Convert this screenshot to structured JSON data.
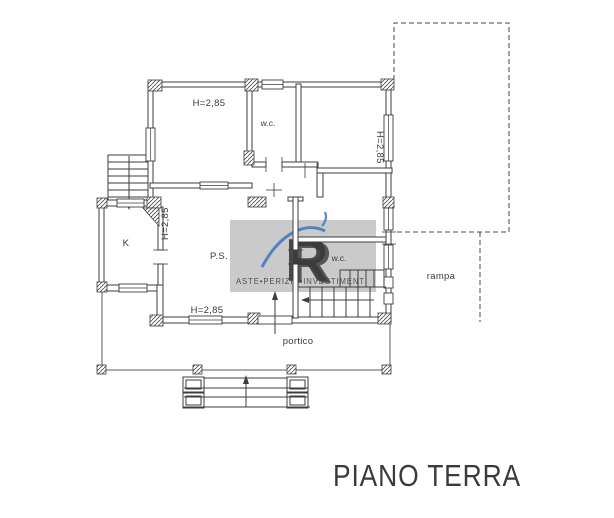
{
  "title": {
    "text": "PIANO TERRA"
  },
  "plan": {
    "labels": {
      "room_top_left_height": "H=2,85",
      "wc_top": "w.c.",
      "room_top_right_height": "H=2,85",
      "hall_left_height": "H=2,85",
      "kitchen": "K",
      "living": "P.S.",
      "wc_inner": "w.c.",
      "ramp": "rampa",
      "portico": "portico",
      "bottom_height": "H=2,85"
    },
    "colors": {
      "line": "#3d3d3d",
      "thin_line": "#5a5a5a",
      "dashed_line": "#4a4a4a",
      "label": "#3a3a3a",
      "title": "#111111",
      "background": "#ffffff"
    }
  },
  "watermark": {
    "logo_letter": "R",
    "text": "ASTE•PERIZIE•INVESTIMENTI",
    "colors": {
      "panel": "#808080",
      "gold": "#b3923c",
      "navy": "#2b3a6b",
      "blue": "#3a78c2",
      "text": "#8f7d3f"
    }
  }
}
